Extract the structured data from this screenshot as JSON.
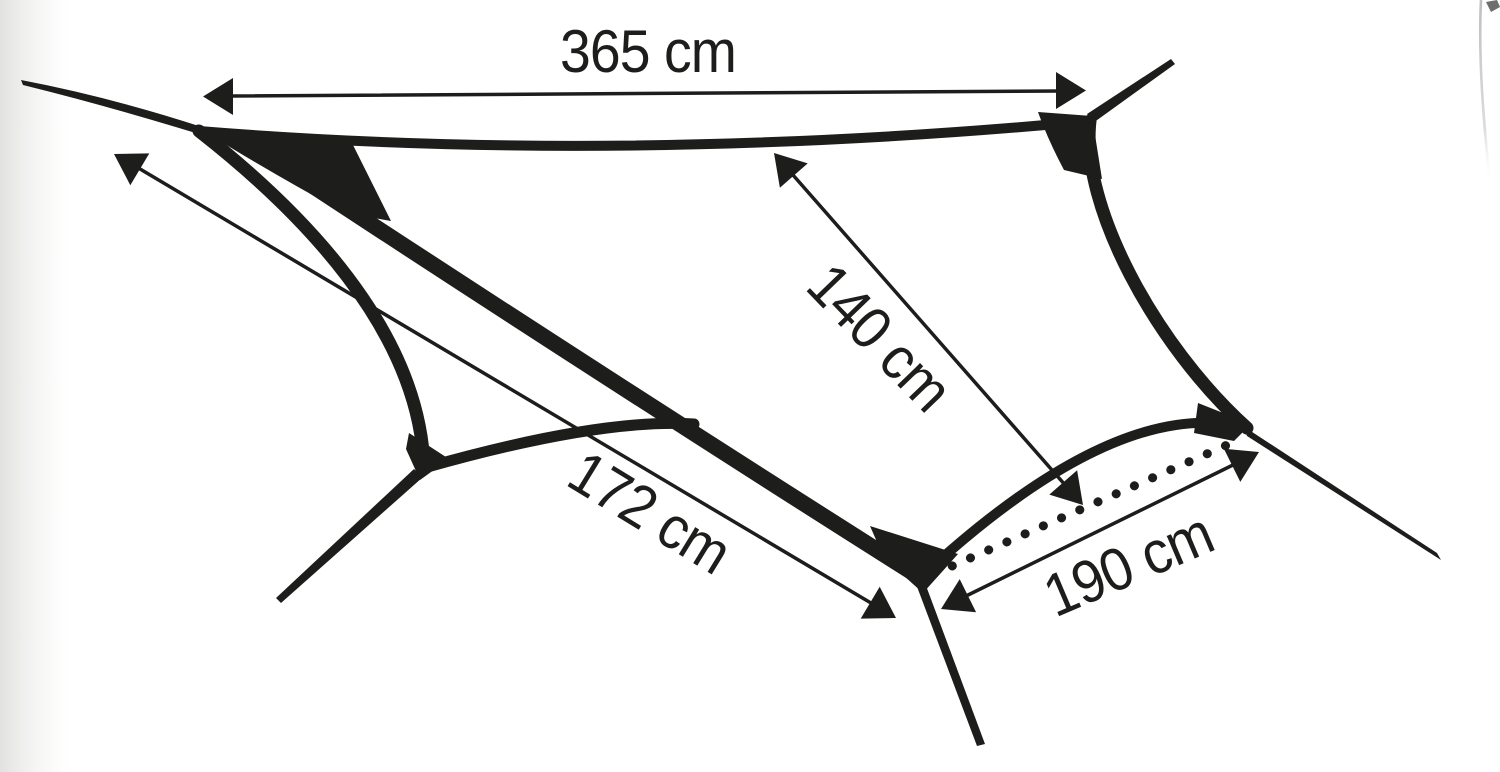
{
  "page": {
    "background": "#ffffff",
    "ink_color": "#1d1d1b",
    "shading_color": "#e9e9e7"
  },
  "diagram": {
    "type": "tarp-dimension-drawing",
    "unit": "cm",
    "measurements": {
      "ridge": {
        "label": "365 cm",
        "value_cm": 365
      },
      "panel_depth": {
        "label": "140 cm",
        "value_cm": 140
      },
      "side_edge": {
        "label": "172 cm",
        "value_cm": 172
      },
      "front_edge": {
        "label": "190 cm",
        "value_cm": 190
      }
    }
  }
}
